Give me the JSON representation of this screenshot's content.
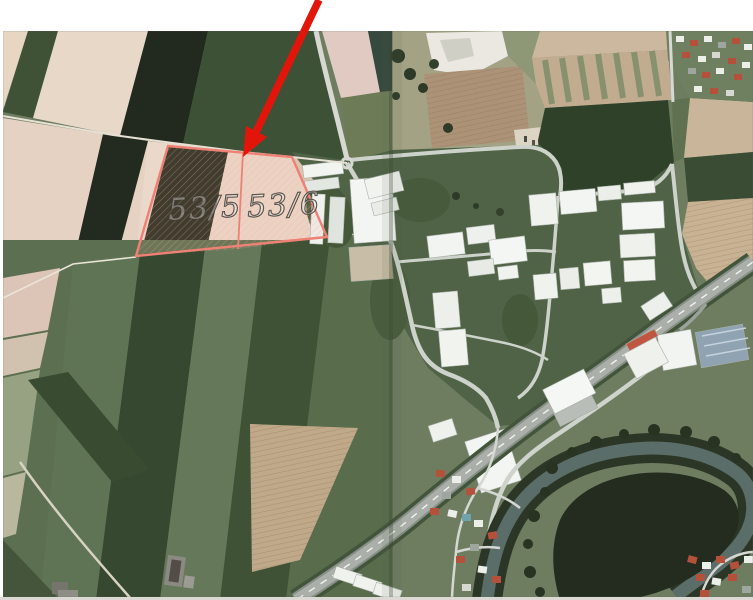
{
  "page": {
    "background": "#ffffff",
    "kind": "scanned aerial orthophoto page with cadastral annotation"
  },
  "annotation": {
    "parcels": [
      {
        "label": "53/5"
      },
      {
        "label": "53/6"
      }
    ],
    "parcel_outline_color": "#ee8175",
    "arrow_color": "#e2150b"
  },
  "photo": {
    "features": [
      "farm field strips",
      "industrial park with warehouses",
      "motorway",
      "river meander with forest",
      "villages",
      "rest stop",
      "booklet fold seam"
    ],
    "colors": {
      "field_beige": "#e8d8c8",
      "field_dark_green": "#3d5137",
      "field_near_black": "#22291e",
      "field_green": "#5c6f50",
      "plowed_tan": "#c8b293",
      "grass_industrial": "#506346",
      "road": "#d6d9d3",
      "highway": "#aab0a9",
      "water": "#5b6d68",
      "forest": "#242c1f",
      "building_white": "#f3f5f2",
      "roof_red": "#b5503a",
      "solar_roof": "#8fa3b2"
    }
  }
}
